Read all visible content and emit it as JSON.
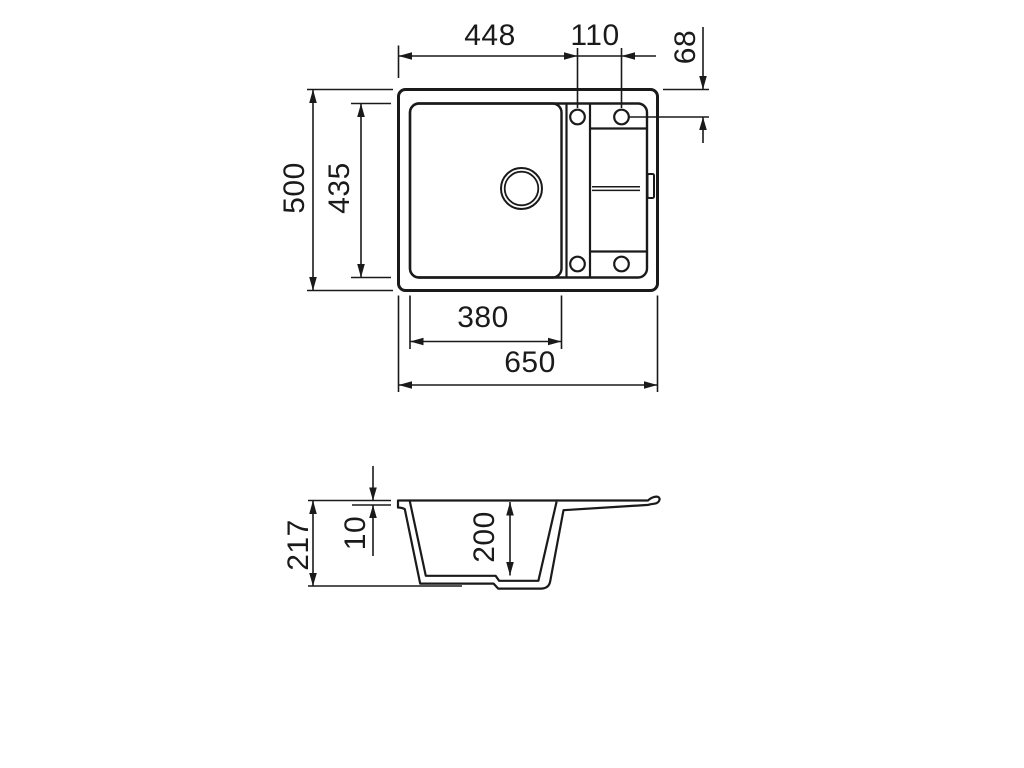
{
  "drawing": {
    "background_color": "#ffffff",
    "line_color": "#1a1a1a"
  },
  "labels": [
    {
      "id": "top-width-to-hole",
      "value": "448"
    },
    {
      "id": "hole-spacing",
      "value": "110"
    },
    {
      "id": "hole-edge-offset",
      "value": "68"
    },
    {
      "id": "overall-depth",
      "value": "500"
    },
    {
      "id": "inner-depth",
      "value": "435"
    },
    {
      "id": "bowl-width",
      "value": "380"
    },
    {
      "id": "overall-width",
      "value": "650"
    },
    {
      "id": "total-height",
      "value": "217"
    },
    {
      "id": "rim-thickness",
      "value": "10"
    },
    {
      "id": "bowl-depth",
      "value": "200"
    }
  ]
}
